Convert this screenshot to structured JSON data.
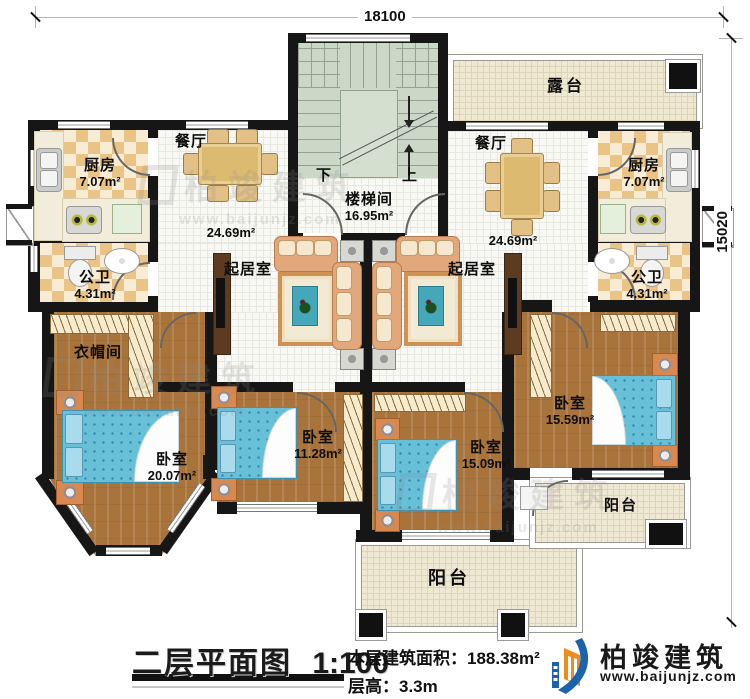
{
  "dimensions": {
    "width_mm": "18100",
    "height_mm": "15020"
  },
  "stairwell": {
    "name": "楼梯间",
    "area": "16.95m²",
    "down_label": "下",
    "up_label": "上"
  },
  "rooms": {
    "terrace": {
      "name": "露台"
    },
    "kitchen_left": {
      "name": "厨房",
      "area": "7.07m²"
    },
    "kitchen_right": {
      "name": "厨房",
      "area": "7.07m²"
    },
    "dining_left": {
      "name": "餐厅"
    },
    "dining_right": {
      "name": "餐厅"
    },
    "living_left": {
      "name": "起居室",
      "area": "24.69m²"
    },
    "living_right": {
      "name": "起居室",
      "area": "24.69m²"
    },
    "bath_left": {
      "name": "公卫",
      "area": "4.31m²"
    },
    "bath_right": {
      "name": "公卫",
      "area": "4.31m²"
    },
    "cloakroom": {
      "name": "衣帽间"
    },
    "bedroom_master": {
      "name": "卧室",
      "area": "20.07m²"
    },
    "bedroom_2": {
      "name": "卧室",
      "area": "11.28m²"
    },
    "bedroom_3": {
      "name": "卧室",
      "area": "15.09m²"
    },
    "bedroom_4": {
      "name": "卧室",
      "area": "15.59m²"
    },
    "balcony_center": {
      "name": "阳台"
    },
    "balcony_right": {
      "name": "阳台"
    }
  },
  "titleblock": {
    "title": "二层平面图",
    "scale": "1:100",
    "floor_area_label": "本层建筑面积：",
    "floor_area_value": "188.38m²",
    "floor_height_label": "层高：",
    "floor_height_value": "3.3m"
  },
  "brand": {
    "name": "柏竣建筑",
    "website": "www.baijunjz.com"
  },
  "watermark": {
    "name": "柏竣建筑",
    "website": "www.baijunjz.com"
  },
  "colors": {
    "wall": "#161616",
    "wood_floor": "#a9743c",
    "checker_dark": "#eac487",
    "checker_light": "#f8ecd4",
    "stair_floor": "#cbd7c7",
    "terrace_floor": "#efe9d4",
    "bed": "#68bfd8",
    "sofa": "#e2a87c",
    "logo_blue": "#1b64ad",
    "logo_orange": "#f08c1e"
  }
}
